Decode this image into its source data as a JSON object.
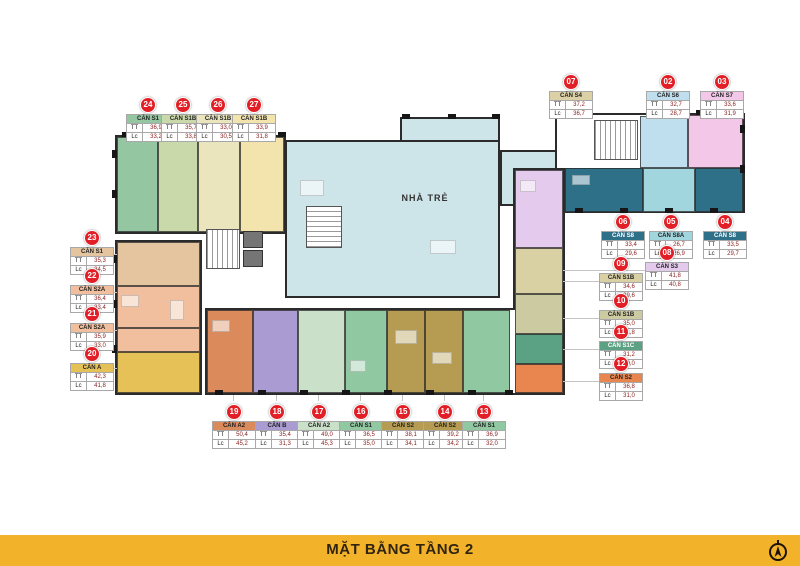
{
  "banner": {
    "title": "MẶT BẰNG TẦNG 2",
    "bg": "#F2B32A"
  },
  "plan": {
    "nursery_label": "NHÀ TRẺ",
    "nursery_color": "#CDE4E9"
  },
  "labels": {
    "tt": "TT",
    "lc": "Lc"
  },
  "badge": {
    "color": "#E21F26"
  },
  "units": [
    {
      "no": "07",
      "code": "CĂN S4",
      "tt": "37,2",
      "lc": "36,7",
      "accent": "#DCD0A6"
    },
    {
      "no": "02",
      "code": "CĂN S6",
      "tt": "32,7",
      "lc": "28,7",
      "accent": "#C0DFEE"
    },
    {
      "no": "03",
      "code": "CĂN S7",
      "tt": "33,6",
      "lc": "31,9",
      "accent": "#F3C7E7"
    },
    {
      "no": "24",
      "code": "CĂN S1",
      "tt": "36,9",
      "lc": "33,2",
      "accent": "#94C6A2"
    },
    {
      "no": "25",
      "code": "CĂN S1B",
      "tt": "35,7",
      "lc": "33,8",
      "accent": "#CAD9A9"
    },
    {
      "no": "26",
      "code": "CĂN S1B",
      "tt": "33,0",
      "lc": "30,5",
      "accent": "#EAE5BC"
    },
    {
      "no": "27",
      "code": "CĂN S1B",
      "tt": "33,9",
      "lc": "31,8",
      "accent": "#F3E3AD"
    },
    {
      "no": "06",
      "code": "CĂN S8",
      "tt": "33,4",
      "lc": "29,6",
      "accent": "#2F7089"
    },
    {
      "no": "05",
      "code": "CĂN S8A",
      "tt": "26,7",
      "lc": "26,9",
      "accent": "#A2D6DF"
    },
    {
      "no": "04",
      "code": "CĂN S8",
      "tt": "33,5",
      "lc": "29,7",
      "accent": "#2F7089"
    },
    {
      "no": "08",
      "code": "CĂN S3",
      "tt": "41,8",
      "lc": "40,8",
      "accent": "#E4CAEC"
    },
    {
      "no": "09",
      "code": "CĂN S1B",
      "tt": "34,6",
      "lc": "29,6",
      "accent": "#D9D0A3"
    },
    {
      "no": "10",
      "code": "CĂN S1B",
      "tt": "35,0",
      "lc": "31,8",
      "accent": "#CCCAA1"
    },
    {
      "no": "11",
      "code": "CĂN S1C",
      "tt": "31,2",
      "lc": "29,0",
      "accent": "#5BA184"
    },
    {
      "no": "12",
      "code": "CĂN S2",
      "tt": "36,8",
      "lc": "31,0",
      "accent": "#E9864F"
    },
    {
      "no": "23",
      "code": "CĂN S1",
      "tt": "35,3",
      "lc": "34,5",
      "accent": "#E4C5A0"
    },
    {
      "no": "22",
      "code": "CĂN S2A",
      "tt": "36,4",
      "lc": "33,4",
      "accent": "#F1BF9E"
    },
    {
      "no": "21",
      "code": "CĂN S2A",
      "tt": "35,9",
      "lc": "33,0",
      "accent": "#F1BF9E"
    },
    {
      "no": "20",
      "code": "CĂN A",
      "tt": "42,3",
      "lc": "41,8",
      "accent": "#E6C158"
    },
    {
      "no": "19",
      "code": "CĂN A2",
      "tt": "50,4",
      "lc": "45,2",
      "accent": "#DA8A5B"
    },
    {
      "no": "18",
      "code": "CĂN B",
      "tt": "35,4",
      "lc": "31,3",
      "accent": "#AA9CD3"
    },
    {
      "no": "17",
      "code": "CĂN A2",
      "tt": "49,0",
      "lc": "45,3",
      "accent": "#CBE0C9"
    },
    {
      "no": "16",
      "code": "CĂN S1",
      "tt": "36,5",
      "lc": "35,0",
      "accent": "#8FC8A1"
    },
    {
      "no": "15",
      "code": "CĂN S2",
      "tt": "38,1",
      "lc": "34,1",
      "accent": "#B59C52"
    },
    {
      "no": "14",
      "code": "CĂN S2",
      "tt": "39,2",
      "lc": "34,2",
      "accent": "#B59C52"
    },
    {
      "no": "13",
      "code": "CĂN S1",
      "tt": "36,9",
      "lc": "32,0",
      "accent": "#8FC8A1"
    }
  ]
}
